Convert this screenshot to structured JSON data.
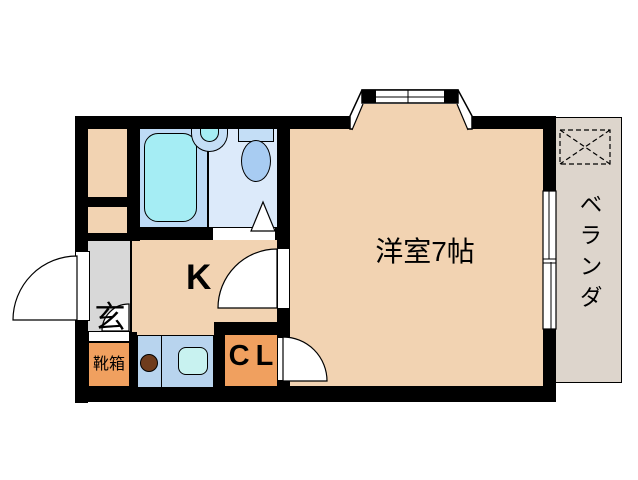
{
  "plan": {
    "type": "apartment-floorplan",
    "labels": {
      "western_room": "洋室7帖",
      "kitchen": "K",
      "entrance": "玄",
      "shoe_box": "靴箱",
      "closet": "CL",
      "balcony": "ベランダ"
    },
    "colors": {
      "wall": "#000000",
      "room_floor": "#f2d3b2",
      "balcony_floor": "#ddd5cc",
      "entrance_floor": "#d8d8d8",
      "storage_orange": "#f0a05f",
      "counter_blue": "#b8d4ee",
      "kitchen_sink": "#c8f2f0",
      "bath_floor": "#bedbf6",
      "washroom_floor": "#dceafa",
      "bathtub": "#a5edf4",
      "fixture_blue": "#c4def6",
      "toilet_bowl": "#a8ccf2",
      "stove_burner": "#6f3c1c"
    }
  }
}
